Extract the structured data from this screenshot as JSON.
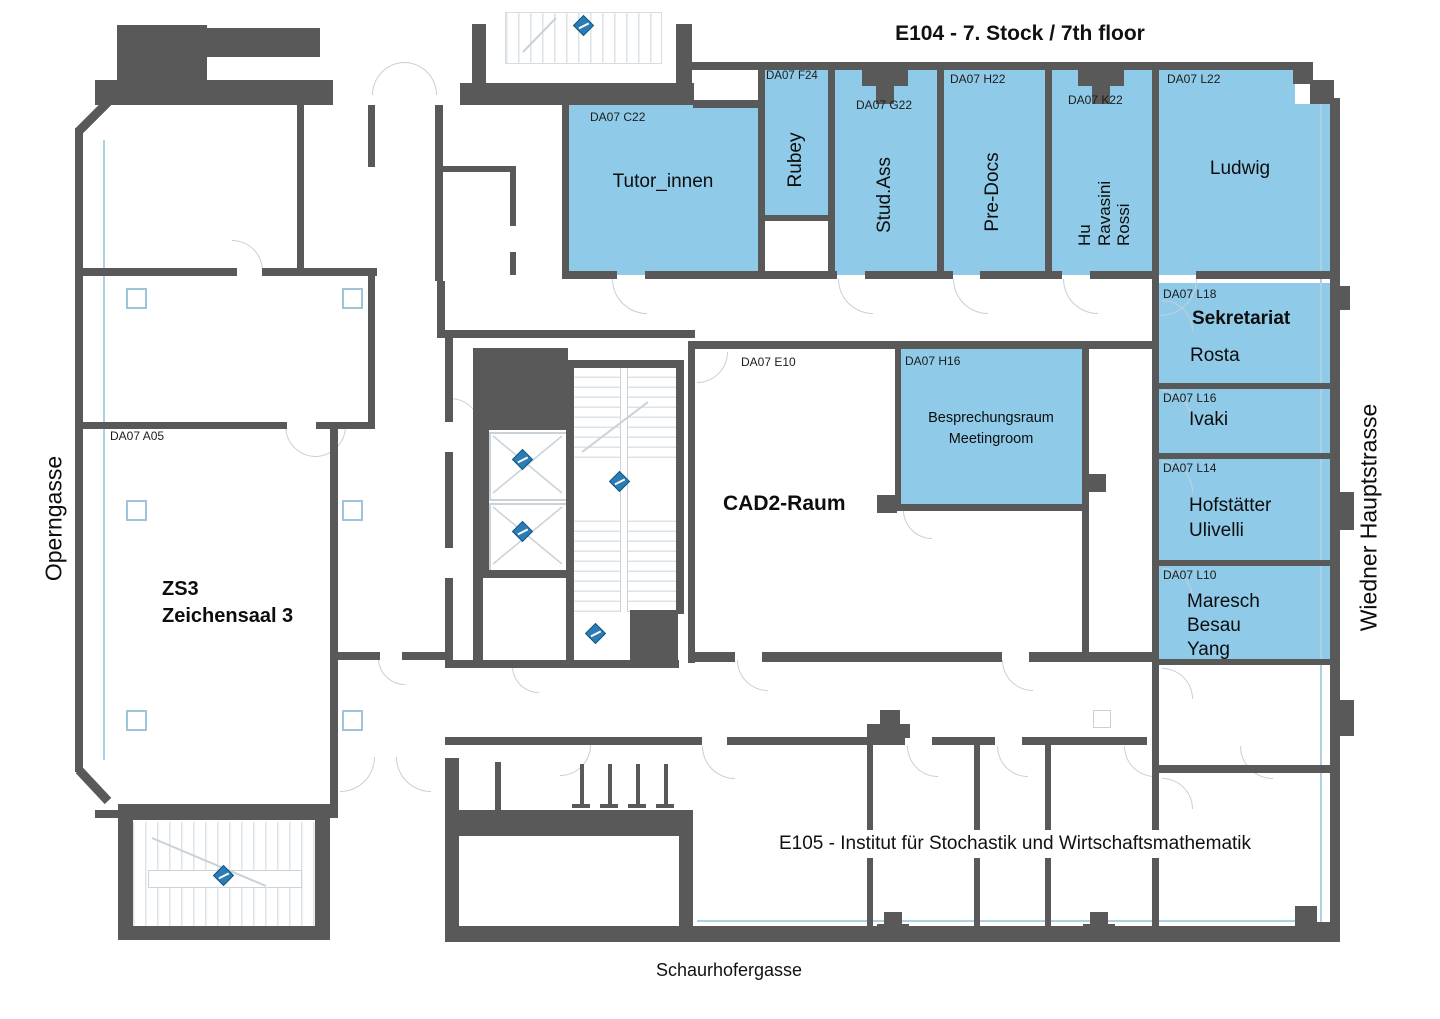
{
  "title": "E104 - 7. Stock / 7th floor",
  "streets": {
    "left": "Operngasse",
    "right": "Wiedner Hauptstrasse",
    "bottom": "Schaurhofergasse"
  },
  "institute_label": "E105 - Institut für Stochastik und Wirtschaftsmathematik",
  "colors": {
    "highlight_room": "#8FCBE9",
    "wall": "#595959",
    "linework": "#C9D2D9",
    "marker_blue": "#2B7CB5"
  },
  "icons": {
    "exit_marker": "escape-route-marker-icon",
    "elevator": "elevator-shaft-cross-icon",
    "stairs": "stair-treads",
    "door": "door-swing-arc",
    "column": "structural-column"
  },
  "rooms": {
    "tutor": {
      "code": "DA07 C22",
      "name": "Tutor_innen"
    },
    "rubey": {
      "code": "DA07 F24",
      "name": "Rubey"
    },
    "studass": {
      "code": "DA07 G22",
      "name": "Stud.Ass"
    },
    "predocs": {
      "code": "DA07 H22",
      "name": "Pre-Docs"
    },
    "hu": {
      "code": "DA07 K22",
      "name": "Hu\nRavasini\nRossi"
    },
    "ludwig": {
      "code": "DA07 L22",
      "name": "Ludwig"
    },
    "sekretariat": {
      "code": "DA07 L18",
      "title": "Sekretariat",
      "name": "Rosta"
    },
    "ivaki": {
      "code": "DA07 L16",
      "name": "Ivaki"
    },
    "hofstaetter": {
      "code": "DA07 L14",
      "name": "Hofstätter\nUlivelli"
    },
    "maresch": {
      "code": "DA07 L10",
      "name": "Maresch\nBesau\nYang"
    },
    "meeting": {
      "code": "DA07 H16",
      "name": "Besprechungsraum\nMeetingroom"
    },
    "cad2": {
      "code": "DA07 E10",
      "name": "CAD2-Raum"
    },
    "zs3": {
      "code": "DA07 A05",
      "name": "ZS3\nZeichensaal 3"
    }
  }
}
